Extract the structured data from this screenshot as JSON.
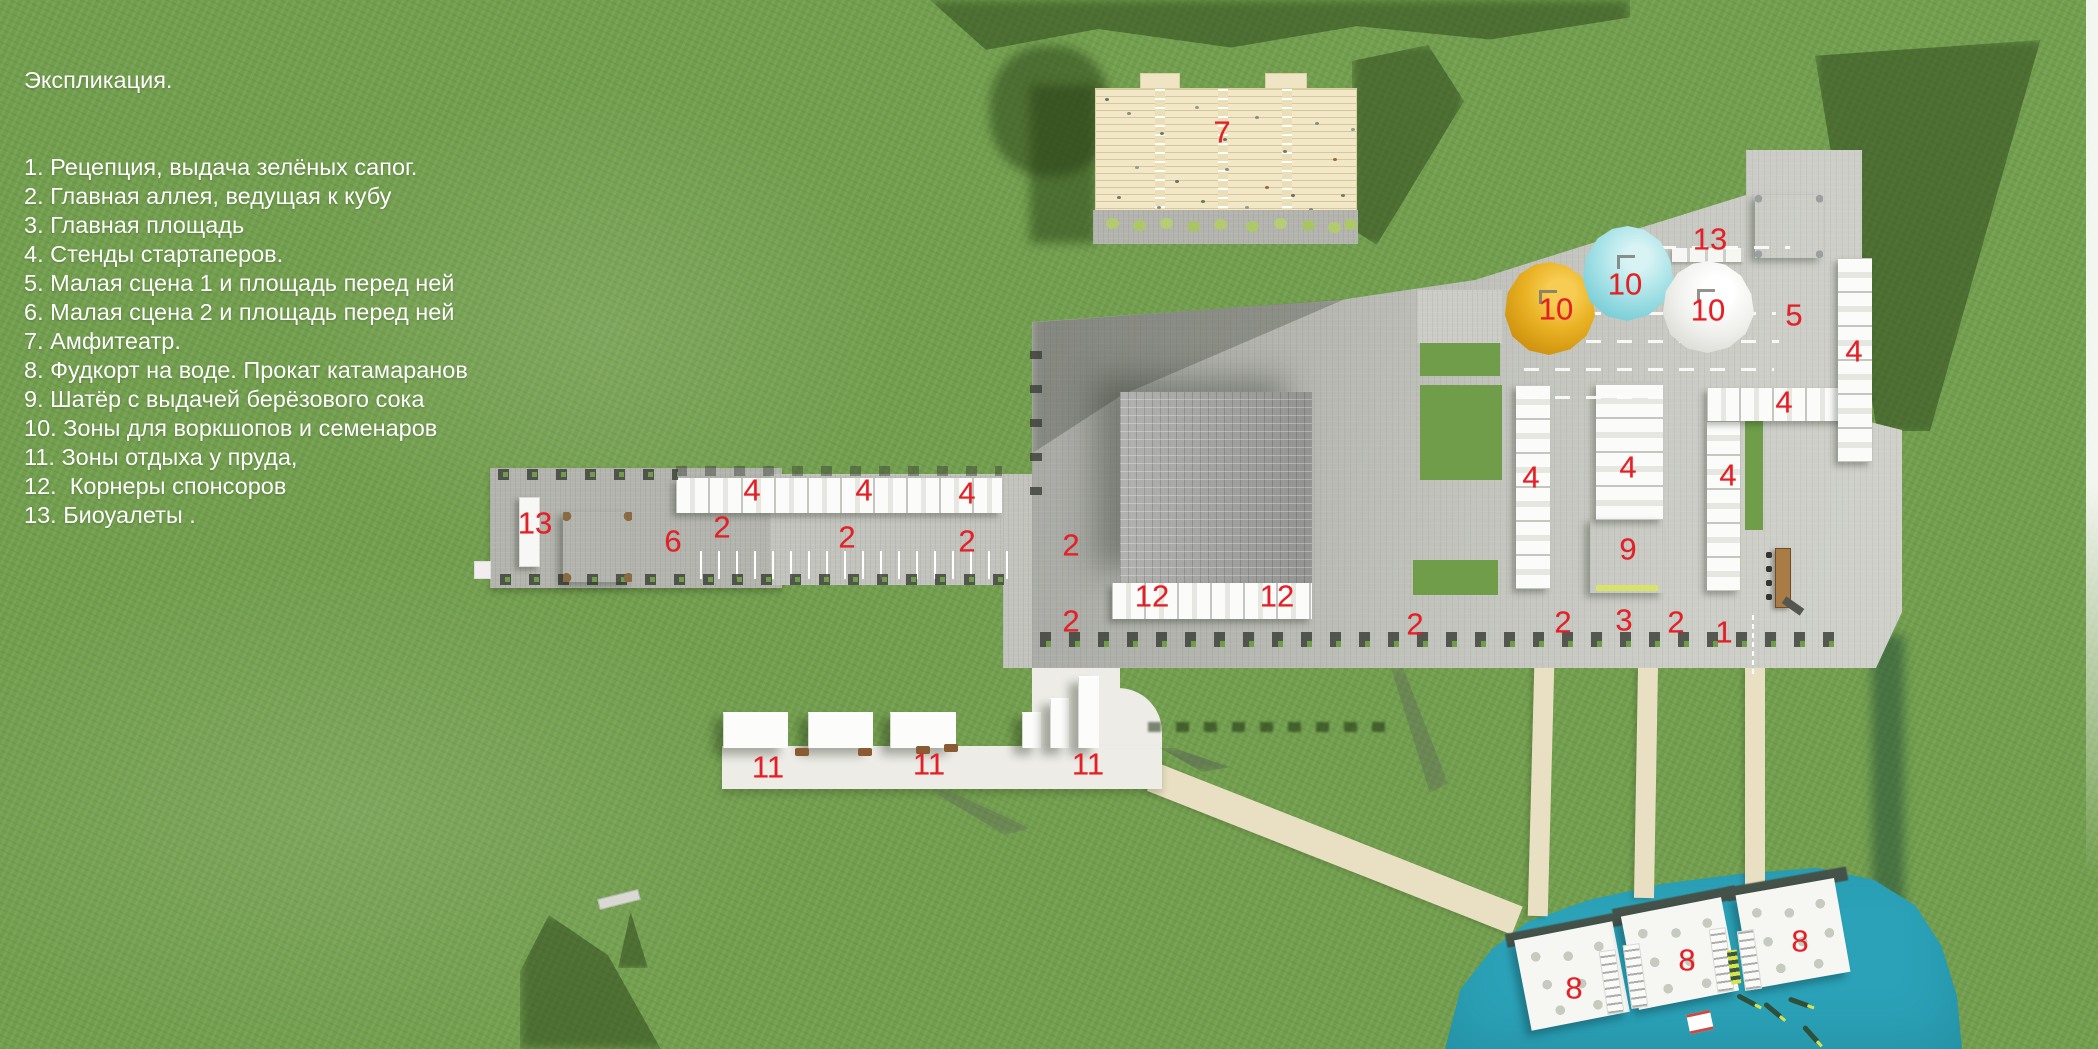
{
  "legend": {
    "title": "Экспликация.",
    "items": [
      "1. Рецепция, выдача зелёных сапог.",
      "2. Главная аллея, ведущая к кубу",
      "3. Главная площадь",
      "4. Стенды стартаперов.",
      "5. Малая сцена 1 и площадь перед ней",
      "6. Малая сцена 2 и площадь перед ней",
      "7. Амфитеатр.",
      "8. Фудкорт на воде. Прокат катамаранов",
      "9. Шатёр с выдачей берёзового сока",
      "10. Зоны для воркшопов и семенаров",
      "11. Зоны отдыха у пруда,",
      "12.  Корнеры спонсоров",
      "13. Биоуалеты ."
    ]
  },
  "map_labels": [
    {
      "text": "7",
      "x": 1222,
      "y": 132
    },
    {
      "text": "13",
      "x": 1710,
      "y": 239
    },
    {
      "text": "10",
      "x": 1556,
      "y": 309
    },
    {
      "text": "10",
      "x": 1625,
      "y": 284
    },
    {
      "text": "10",
      "x": 1708,
      "y": 310
    },
    {
      "text": "5",
      "x": 1794,
      "y": 315
    },
    {
      "text": "4",
      "x": 1854,
      "y": 351
    },
    {
      "text": "4",
      "x": 1784,
      "y": 402
    },
    {
      "text": "4",
      "x": 1531,
      "y": 477
    },
    {
      "text": "4",
      "x": 1628,
      "y": 467
    },
    {
      "text": "4",
      "x": 1728,
      "y": 475
    },
    {
      "text": "9",
      "x": 1628,
      "y": 549
    },
    {
      "text": "13",
      "x": 535,
      "y": 523
    },
    {
      "text": "6",
      "x": 673,
      "y": 541
    },
    {
      "text": "2",
      "x": 722,
      "y": 527
    },
    {
      "text": "4",
      "x": 752,
      "y": 490
    },
    {
      "text": "2",
      "x": 847,
      "y": 537
    },
    {
      "text": "4",
      "x": 864,
      "y": 490
    },
    {
      "text": "4",
      "x": 967,
      "y": 493
    },
    {
      "text": "2",
      "x": 967,
      "y": 541
    },
    {
      "text": "2",
      "x": 1071,
      "y": 545
    },
    {
      "text": "2",
      "x": 1071,
      "y": 621
    },
    {
      "text": "12",
      "x": 1152,
      "y": 596
    },
    {
      "text": "12",
      "x": 1277,
      "y": 596
    },
    {
      "text": "2",
      "x": 1415,
      "y": 624
    },
    {
      "text": "2",
      "x": 1563,
      "y": 622
    },
    {
      "text": "3",
      "x": 1624,
      "y": 620
    },
    {
      "text": "2",
      "x": 1676,
      "y": 622
    },
    {
      "text": "1",
      "x": 1724,
      "y": 632
    },
    {
      "text": "11",
      "x": 768,
      "y": 767
    },
    {
      "text": "11",
      "x": 929,
      "y": 764
    },
    {
      "text": "11",
      "x": 1088,
      "y": 764
    },
    {
      "text": "8",
      "x": 1574,
      "y": 988
    },
    {
      "text": "8",
      "x": 1687,
      "y": 960
    },
    {
      "text": "8",
      "x": 1800,
      "y": 941
    }
  ],
  "colors": {
    "grass": "#719e4c",
    "paving": "#c2c3bd",
    "sand": "#e9dfc3",
    "white_path": "#edece7",
    "water": "#2ba2b8",
    "amphi": "#f2e8c7",
    "cube": "#a9a9a7",
    "tent": "#fbfbfa",
    "dome_yellow": "#e0a01a",
    "dome_cyan": "#9adbe2",
    "dome_white": "#f0f0ee",
    "wall": "#44524a",
    "label_red": "#e41f25",
    "text_white": "#ffffff"
  }
}
